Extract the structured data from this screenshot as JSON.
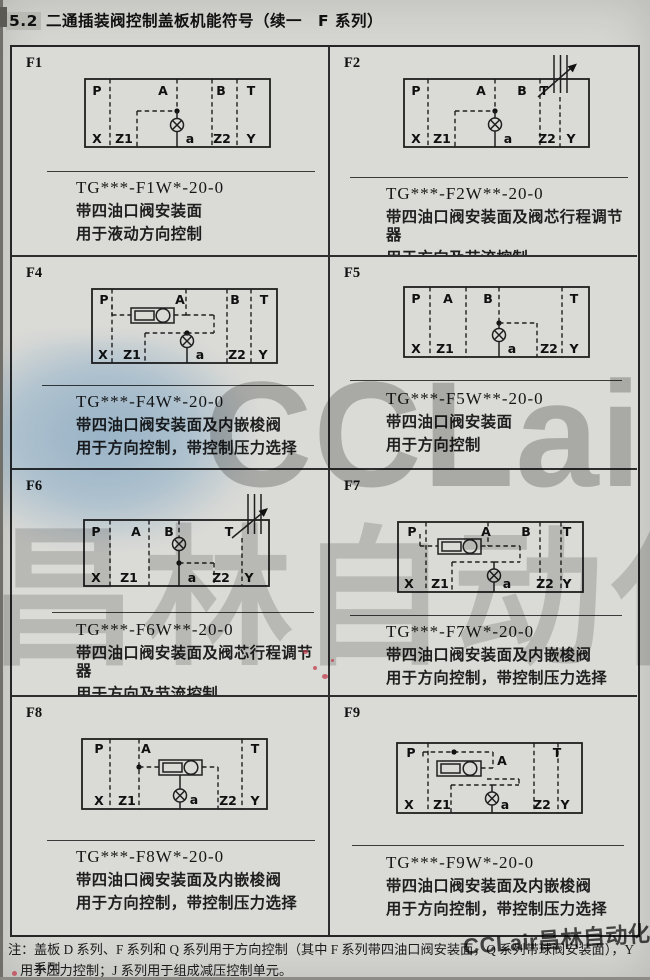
{
  "page": {
    "title_num": "5.2",
    "title_text": "二通插装阀控制盖板机能符号（续一　F 系列）",
    "note_label": "注：",
    "note_line1": "盖板 D 系列、F 系列和 Q 系列用于方向控制（其中 F 系列带四油口阀安装面，Q 系列带球阀安装面），Y 系列",
    "note_line2": "用于压力控制；J 系列用于组成减压控制单元。",
    "watermark_center_text": "CCLair",
    "watermark_center_cjk": "昌林自动化",
    "watermark_corner": "CCLair昌林自动化",
    "colors": {
      "paper": "#d6d6d2",
      "table_border": "#262626",
      "watermark_blue": "#9ec6e8",
      "watermark_gray": "#8d8d8d",
      "red_mark": "#c23345"
    }
  },
  "cells": [
    {
      "id": "F1",
      "code": "TG***-F1W*-20-0",
      "desc1": "带四油口阀安装面",
      "desc2": "用于液动方向控制",
      "ports_top": [
        "P",
        "A",
        "B",
        "T"
      ],
      "ports_bottom": [
        "X",
        "Z1",
        "a",
        "Z2",
        "Y"
      ]
    },
    {
      "id": "F2",
      "code": "TG***-F2W**-20-0",
      "desc1": "带四油口阀安装面及阀芯行程调节器",
      "desc2": "用于方向及节流控制",
      "ports_top": [
        "P",
        "A",
        "B",
        "T"
      ],
      "ports_bottom": [
        "X",
        "Z1",
        "a",
        "Z2",
        "Y"
      ]
    },
    {
      "id": "F4",
      "code": "TG***-F4W*-20-0",
      "desc1": "带四油口阀安装面及内嵌梭阀",
      "desc2": "用于方向控制，带控制压力选择",
      "ports_top": [
        "P",
        "A",
        "B",
        "T"
      ],
      "ports_bottom": [
        "X",
        "Z1",
        "a",
        "Z2",
        "Y"
      ]
    },
    {
      "id": "F5",
      "code": "TG***-F5W**-20-0",
      "desc1": "带四油口阀安装面",
      "desc2": "用于方向控制",
      "ports_top": [
        "P",
        "A",
        "B",
        "T"
      ],
      "ports_bottom": [
        "X",
        "Z1",
        "a",
        "Z2",
        "Y"
      ]
    },
    {
      "id": "F6",
      "code": "TG***-F6W**-20-0",
      "desc1": "带四油口阀安装面及阀芯行程调节器",
      "desc2": "用于方向及节流控制",
      "ports_top": [
        "P",
        "A",
        "B",
        "T"
      ],
      "ports_bottom": [
        "X",
        "Z1",
        "a",
        "Z2",
        "Y"
      ]
    },
    {
      "id": "F7",
      "code": "TG***-F7W*-20-0",
      "desc1": "带四油口阀安装面及内嵌梭阀",
      "desc2": "用于方向控制，带控制压力选择",
      "ports_top": [
        "P",
        "A",
        "B",
        "T"
      ],
      "ports_bottom": [
        "X",
        "Z1",
        "a",
        "Z2",
        "Y"
      ]
    },
    {
      "id": "F8",
      "code": "TG***-F8W*-20-0",
      "desc1": "带四油口阀安装面及内嵌梭阀",
      "desc2": "用于方向控制，带控制压力选择",
      "ports_top": [
        "P",
        "A",
        "T"
      ],
      "ports_bottom": [
        "X",
        "Z1",
        "a",
        "Z2",
        "Y"
      ]
    },
    {
      "id": "F9",
      "code": "TG***-F9W*-20-0",
      "desc1": "带四油口阀安装面及内嵌梭阀",
      "desc2": "用于方向控制，带控制压力选择",
      "ports_top": [
        "P",
        "A",
        "T"
      ],
      "ports_bottom": [
        "X",
        "Z1",
        "a",
        "Z2",
        "Y"
      ]
    }
  ]
}
